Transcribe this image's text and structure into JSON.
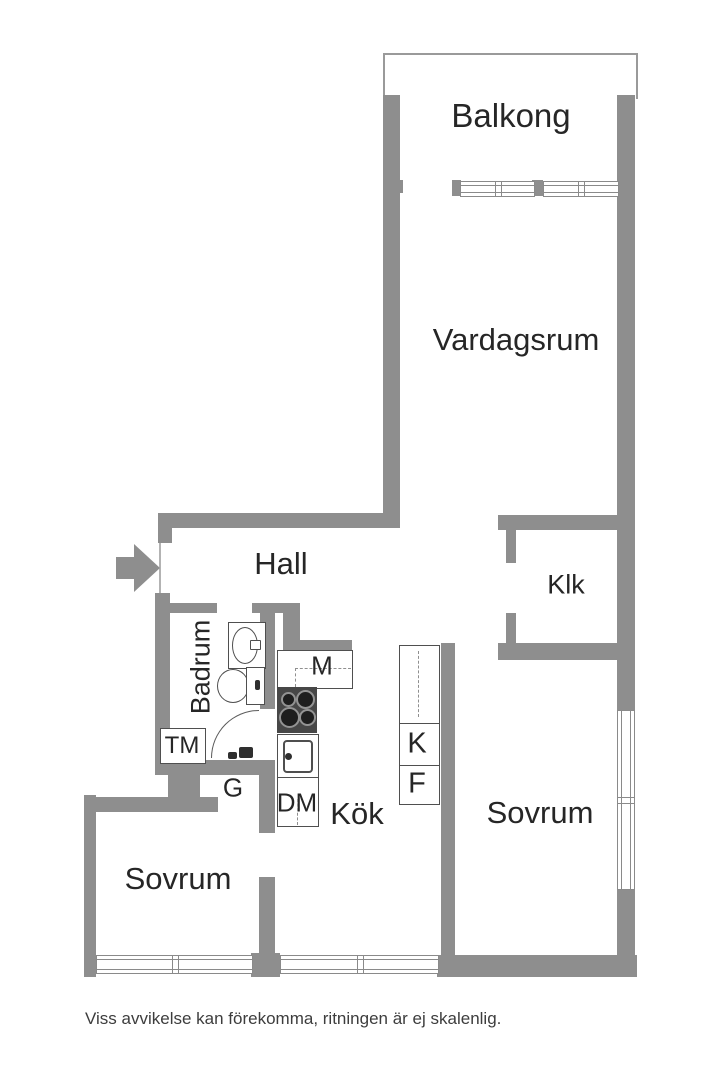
{
  "plan": {
    "rooms": {
      "balcony": "Balkong",
      "living_room": "Vardagsrum",
      "hall": "Hall",
      "closet": "Klk",
      "bathroom": "Badrum",
      "kitchen": "Kök",
      "bedroom_left": "Sovrum",
      "bedroom_right": "Sovrum"
    },
    "labels": {
      "cabinet_m": "M",
      "washing_machine": "TM",
      "wardrobe": "G",
      "dishwasher": "DM",
      "fridge": "K",
      "freezer": "F"
    },
    "disclaimer": "Viss avvikelse kan förekomma, ritningen är ej skalenlig.",
    "colors": {
      "wall": "#8e8e8e",
      "fixture_line": "#4f4f4f",
      "text": "#262626",
      "window_line": "#8a8a8a"
    }
  }
}
